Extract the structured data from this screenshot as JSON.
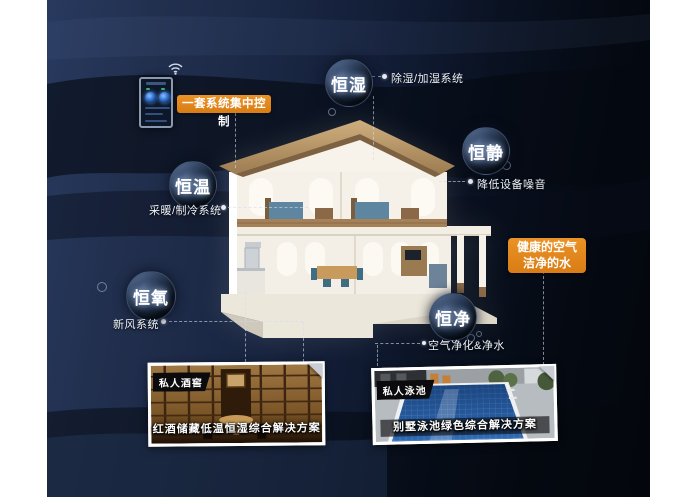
{
  "colors": {
    "accent_orange": "#e0861c",
    "background_navy": "#1f2e50",
    "background_black": "#05070c",
    "bubble_dark": "#101b2c",
    "note_text": "#eef2f8"
  },
  "controller": {
    "label": "一套系统集中控制",
    "icon": "smart-control-panel",
    "wifi": "wifi-signal"
  },
  "bubbles": [
    {
      "label": "恒湿",
      "note": "除湿/加湿系统"
    },
    {
      "label": "恒静",
      "note": "降低设备噪音"
    },
    {
      "label": "恒温",
      "note": "采暖/制冷系统"
    },
    {
      "label": "恒氧",
      "note": "新风系统"
    },
    {
      "label": "恒净",
      "note": "空气净化&净水"
    }
  ],
  "highlight": {
    "line1": "健康的空气",
    "line2": "洁净的水"
  },
  "cards": [
    {
      "tag": "私人酒窖",
      "caption": "红酒储藏低温恒湿综合解决方案"
    },
    {
      "tag": "私人泳池",
      "caption": "别墅泳池绿色综合解决方案"
    }
  ]
}
